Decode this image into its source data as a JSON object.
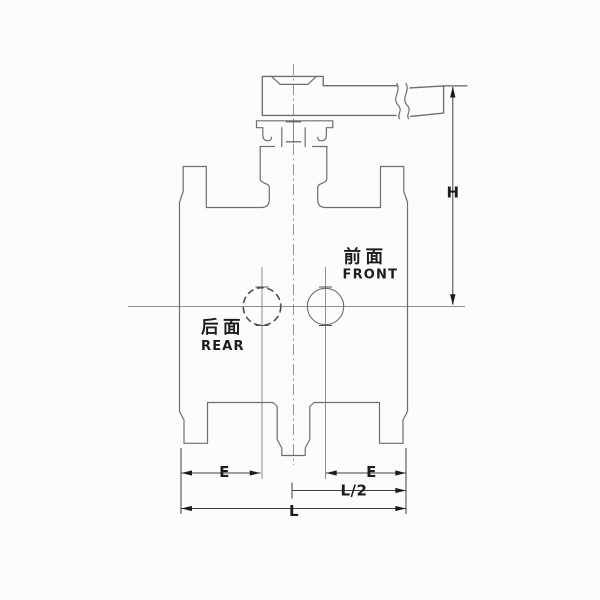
{
  "annotations": {
    "front": {
      "cn": "前面",
      "en": "FRONT"
    },
    "rear": {
      "cn": "后面",
      "en": "REAR"
    }
  },
  "dimensions": {
    "h": "H",
    "e_left": "E",
    "e_right": "E",
    "half_length": "L/2",
    "length": "L"
  },
  "colors": {
    "background": "#fcfcfc",
    "outline": "#6e6e6e",
    "centerline": "#8f8f8f",
    "dimension": "#3f3f3f",
    "arrow": "#1b1b1b",
    "text": "#1c1c1c"
  }
}
